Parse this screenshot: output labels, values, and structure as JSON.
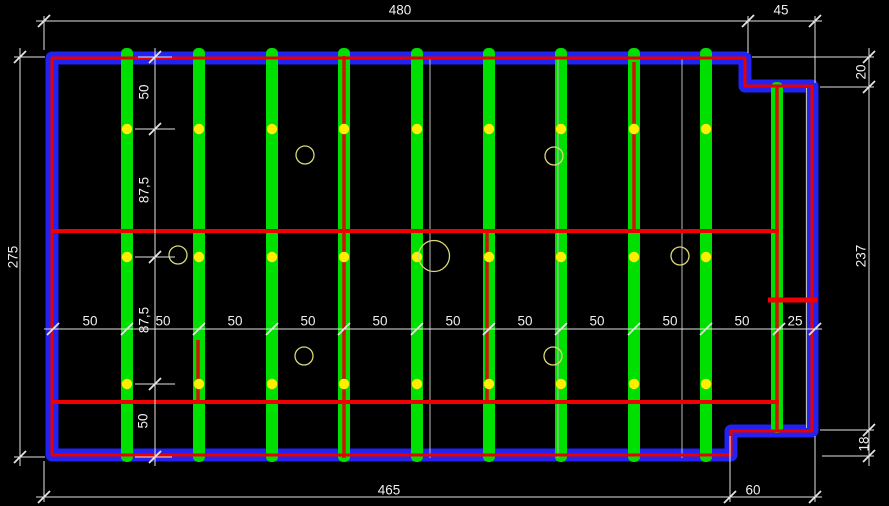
{
  "app": {
    "type": "cad-framing-plan",
    "canvas_width": 889,
    "canvas_height": 506,
    "background": "#000000"
  },
  "colors": {
    "wall_blue": "#2222f2",
    "wall_red": "#e80000",
    "joist_green": "#00e000",
    "core_red": "#d01400",
    "line_red": "#f00000",
    "dot_yellow": "#ffee00",
    "circle_yellow": "#d8d878",
    "dim_white": "#e4e4e4",
    "construction_white": "#bdbdbd",
    "text_white": "#eeeeee"
  },
  "wall": {
    "path": "M 52,58 L 745,58 L 745,86 L 812,86 L 812,431 L 731,431 L 731,455 L 52,455 Z",
    "blue_width": 13,
    "red_width": 3
  },
  "strips": {
    "width": 12,
    "items": [
      {
        "x": 127,
        "y1": 48,
        "y2": 462
      },
      {
        "x": 199,
        "y1": 48,
        "y2": 462
      },
      {
        "x": 272,
        "y1": 48,
        "y2": 462
      },
      {
        "x": 344,
        "y1": 48,
        "y2": 462
      },
      {
        "x": 417,
        "y1": 48,
        "y2": 462
      },
      {
        "x": 489,
        "y1": 48,
        "y2": 462
      },
      {
        "x": 561,
        "y1": 48,
        "y2": 462
      },
      {
        "x": 634,
        "y1": 48,
        "y2": 462
      },
      {
        "x": 706,
        "y1": 48,
        "y2": 462
      },
      {
        "x": 777,
        "y1": 82,
        "y2": 433
      }
    ]
  },
  "red_cores": {
    "width": 3.5,
    "items": [
      {
        "x": 344,
        "y1": 56,
        "y2": 458
      },
      {
        "x": 487,
        "y1": 232,
        "y2": 402
      },
      {
        "x": 634,
        "y1": 62,
        "y2": 232
      },
      {
        "x": 198,
        "y1": 340,
        "y2": 402
      },
      {
        "x": 777,
        "y1": 86,
        "y2": 430
      }
    ]
  },
  "construction_lines": [
    {
      "x1": 430,
      "y1": 57,
      "x2": 430,
      "y2": 458
    },
    {
      "x1": 558,
      "y1": 57,
      "x2": 558,
      "y2": 458
    },
    {
      "x1": 682,
      "y1": 57,
      "x2": 682,
      "y2": 458
    },
    {
      "x1": 806.5,
      "y1": 88,
      "x2": 806.5,
      "y2": 428
    }
  ],
  "red_lines": [
    {
      "x1": 51,
      "y1": 231,
      "x2": 779,
      "y2": 231,
      "w": 4
    },
    {
      "x1": 51,
      "y1": 402,
      "x2": 779,
      "y2": 402,
      "w": 4
    },
    {
      "x1": 768,
      "y1": 300,
      "x2": 817,
      "y2": 300,
      "w": 5
    }
  ],
  "dots": {
    "r": 5.2,
    "rows": [
      129,
      257,
      384
    ],
    "xs": [
      127,
      199,
      272,
      344,
      417,
      489,
      561,
      634,
      706
    ]
  },
  "circles": [
    {
      "cx": 305,
      "cy": 155,
      "r": 9
    },
    {
      "cx": 554,
      "cy": 156,
      "r": 9
    },
    {
      "cx": 178,
      "cy": 255,
      "r": 9
    },
    {
      "cx": 680,
      "cy": 256,
      "r": 9
    },
    {
      "cx": 434,
      "cy": 256,
      "r": 15.5
    },
    {
      "cx": 304,
      "cy": 356,
      "r": 9
    },
    {
      "cx": 553,
      "cy": 356,
      "r": 9
    }
  ],
  "dimensions": {
    "lines": [
      {
        "x1": 36,
        "y1": 21,
        "x2": 822,
        "y2": 21
      },
      {
        "x1": 44,
        "y1": 16,
        "x2": 44,
        "y2": 50
      },
      {
        "x1": 748,
        "y1": 16,
        "x2": 748,
        "y2": 53
      },
      {
        "x1": 815,
        "y1": 16,
        "x2": 815,
        "y2": 83
      },
      {
        "x1": 20,
        "y1": 48,
        "x2": 20,
        "y2": 466
      },
      {
        "x1": 14,
        "y1": 57,
        "x2": 45,
        "y2": 57
      },
      {
        "x1": 14,
        "y1": 457,
        "x2": 45,
        "y2": 457
      },
      {
        "x1": 36,
        "y1": 497,
        "x2": 822,
        "y2": 497
      },
      {
        "x1": 44,
        "y1": 461,
        "x2": 44,
        "y2": 502
      },
      {
        "x1": 730,
        "y1": 436,
        "x2": 730,
        "y2": 502
      },
      {
        "x1": 815,
        "y1": 436,
        "x2": 815,
        "y2": 502
      },
      {
        "x1": 869,
        "y1": 48,
        "x2": 869,
        "y2": 466
      },
      {
        "x1": 752,
        "y1": 57,
        "x2": 874,
        "y2": 57
      },
      {
        "x1": 820,
        "y1": 87,
        "x2": 874,
        "y2": 87
      },
      {
        "x1": 820,
        "y1": 430,
        "x2": 874,
        "y2": 430
      },
      {
        "x1": 822,
        "y1": 456,
        "x2": 874,
        "y2": 456
      },
      {
        "x1": 155,
        "y1": 48,
        "x2": 155,
        "y2": 466
      },
      {
        "x1": 138,
        "y1": 57,
        "x2": 172,
        "y2": 57
      },
      {
        "x1": 135,
        "y1": 129,
        "x2": 175,
        "y2": 129
      },
      {
        "x1": 135,
        "y1": 257,
        "x2": 175,
        "y2": 257
      },
      {
        "x1": 135,
        "y1": 384,
        "x2": 175,
        "y2": 384
      },
      {
        "x1": 135,
        "y1": 457,
        "x2": 172,
        "y2": 457
      },
      {
        "x1": 44,
        "y1": 329,
        "x2": 822,
        "y2": 329
      }
    ],
    "ticks": [
      {
        "x": 44,
        "y": 21
      },
      {
        "x": 748,
        "y": 21
      },
      {
        "x": 815,
        "y": 21
      },
      {
        "x": 20,
        "y": 57
      },
      {
        "x": 20,
        "y": 457
      },
      {
        "x": 44,
        "y": 497
      },
      {
        "x": 730,
        "y": 497
      },
      {
        "x": 815,
        "y": 497
      },
      {
        "x": 869,
        "y": 57
      },
      {
        "x": 869,
        "y": 87
      },
      {
        "x": 869,
        "y": 430
      },
      {
        "x": 869,
        "y": 456
      },
      {
        "x": 155,
        "y": 57
      },
      {
        "x": 155,
        "y": 129
      },
      {
        "x": 155,
        "y": 257
      },
      {
        "x": 155,
        "y": 384
      },
      {
        "x": 155,
        "y": 457
      },
      {
        "x": 53,
        "y": 329
      },
      {
        "x": 127,
        "y": 329
      },
      {
        "x": 199,
        "y": 329
      },
      {
        "x": 272,
        "y": 329
      },
      {
        "x": 344,
        "y": 329
      },
      {
        "x": 417,
        "y": 329
      },
      {
        "x": 489,
        "y": 329
      },
      {
        "x": 561,
        "y": 329
      },
      {
        "x": 634,
        "y": 329
      },
      {
        "x": 706,
        "y": 329
      },
      {
        "x": 779,
        "y": 329
      },
      {
        "x": 815,
        "y": 329
      }
    ],
    "texts": [
      {
        "t": "480",
        "x": 400,
        "y": 10,
        "rot": 0
      },
      {
        "t": "45",
        "x": 781,
        "y": 10,
        "rot": 0
      },
      {
        "t": "275",
        "x": 13,
        "y": 257,
        "rot": -90
      },
      {
        "t": "20",
        "x": 861,
        "y": 72,
        "rot": -90
      },
      {
        "t": "237",
        "x": 861,
        "y": 256,
        "rot": -90
      },
      {
        "t": "18",
        "x": 864,
        "y": 444,
        "rot": -90
      },
      {
        "t": "465",
        "x": 389,
        "y": 490,
        "rot": 0
      },
      {
        "t": "60",
        "x": 753,
        "y": 490,
        "rot": 0
      },
      {
        "t": "50",
        "x": 144,
        "y": 92,
        "rot": -90
      },
      {
        "t": "87,5",
        "x": 144,
        "y": 190,
        "rot": -90
      },
      {
        "t": "87,5",
        "x": 144,
        "y": 320,
        "rot": -90
      },
      {
        "t": "50",
        "x": 143,
        "y": 421,
        "rot": -90
      },
      {
        "t": "50",
        "x": 90,
        "y": 321,
        "rot": 0
      },
      {
        "t": "50",
        "x": 163,
        "y": 321,
        "rot": 0
      },
      {
        "t": "50",
        "x": 235,
        "y": 321,
        "rot": 0
      },
      {
        "t": "50",
        "x": 308,
        "y": 321,
        "rot": 0
      },
      {
        "t": "50",
        "x": 380,
        "y": 321,
        "rot": 0
      },
      {
        "t": "50",
        "x": 453,
        "y": 321,
        "rot": 0
      },
      {
        "t": "50",
        "x": 525,
        "y": 321,
        "rot": 0
      },
      {
        "t": "50",
        "x": 597,
        "y": 321,
        "rot": 0
      },
      {
        "t": "50",
        "x": 670,
        "y": 321,
        "rot": 0
      },
      {
        "t": "50",
        "x": 742,
        "y": 321,
        "rot": 0
      },
      {
        "t": "25",
        "x": 795,
        "y": 321,
        "rot": 0
      }
    ],
    "font_size": 13.5,
    "tick_len": 6
  }
}
